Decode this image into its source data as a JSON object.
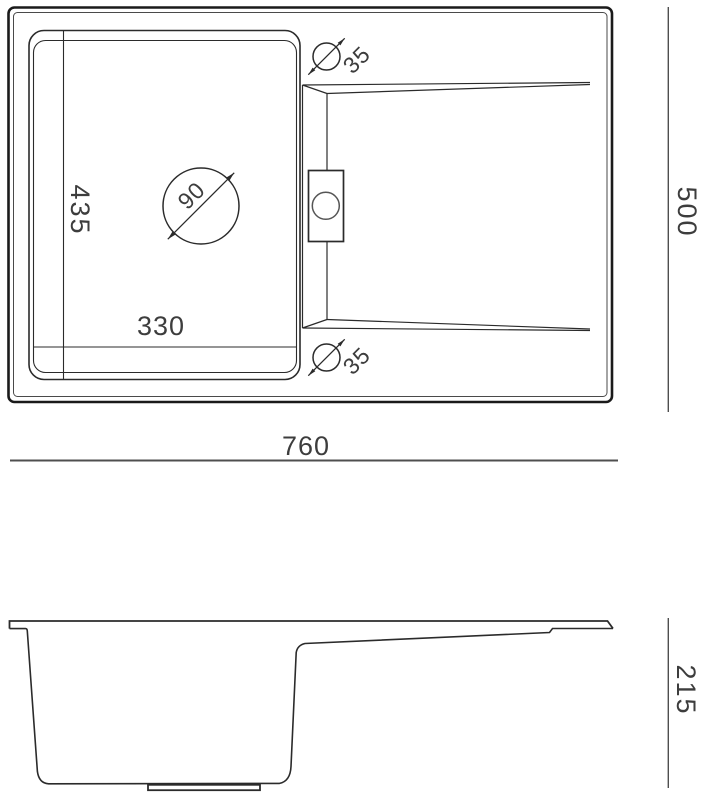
{
  "colors": {
    "line": "#2b2b2b",
    "frame": "#1a1a1a",
    "dim_line": "#4f4f4f",
    "text": "#3d3d3d"
  },
  "top_view": {
    "bowl_depth": "435",
    "bowl_width": "330",
    "drain_diameter": "90",
    "tap_hole_top_diameter": "35",
    "tap_hole_bottom_diameter": "35",
    "overall_width": "760",
    "overall_depth": "500"
  },
  "side_view": {
    "height": "215"
  }
}
